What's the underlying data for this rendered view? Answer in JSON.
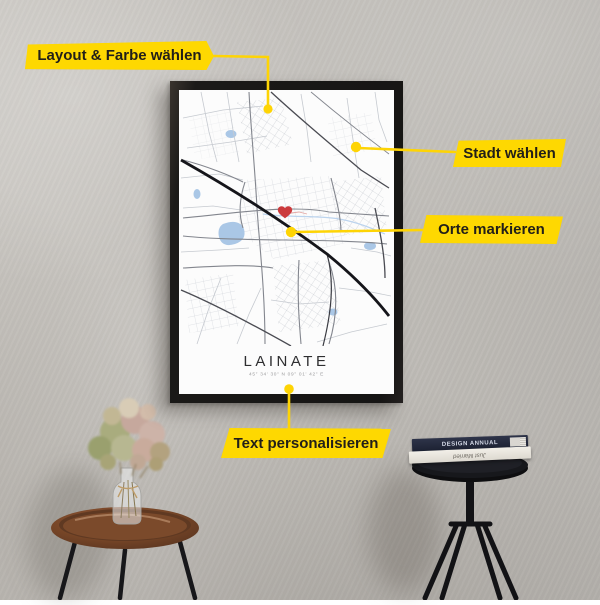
{
  "callouts": {
    "accent_color": "#fed801",
    "text_color": "#221f19",
    "items": [
      {
        "id": "layout",
        "label": "Layout & Farbe wählen"
      },
      {
        "id": "city",
        "label": "Stadt wählen"
      },
      {
        "id": "places",
        "label": "Orte markieren"
      },
      {
        "id": "text",
        "label": "Text personalisieren"
      }
    ]
  },
  "poster": {
    "city_title": "LAINATE",
    "coordinates": "45° 34' 30\" N   09° 01' 42\" E",
    "marker_icon": "heart-icon",
    "colors": {
      "frame": "#1b1a18",
      "map_background": "#fcfcfc",
      "highway": "#15151a",
      "roads": "#83868e",
      "streets": "#c6cad0",
      "water": "#aac7e6",
      "heart": "#cb3a3c"
    }
  },
  "props": {
    "books": [
      {
        "spine_text": "DESIGN ANNUAL",
        "spine_color": "#252a3a"
      },
      {
        "spine_text": "Just Married",
        "spine_color": "#efece5"
      }
    ]
  }
}
